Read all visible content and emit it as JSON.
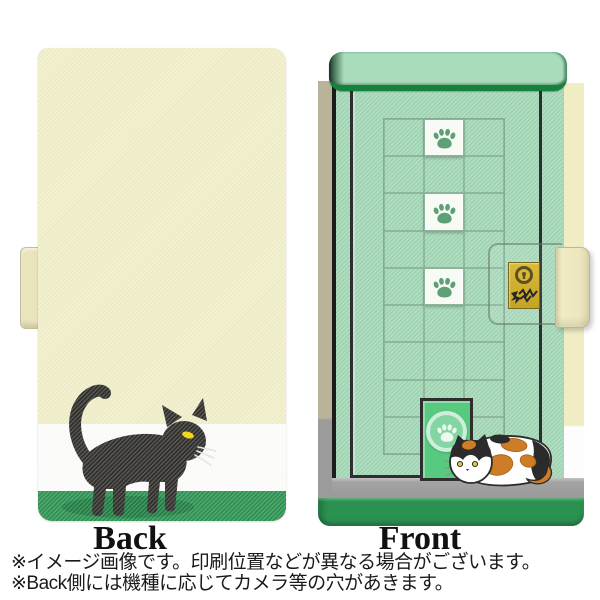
{
  "labels": {
    "back": "Back",
    "front": "Front"
  },
  "footnotes": [
    "※イメージ画像です。印刷位置などが異なる場合がございます。",
    "※Back側には機種に応じてカメラ等の穴があきます。"
  ],
  "back_cover": {
    "bands": {
      "cream": "#f1efc8",
      "white": "#fdfdfb",
      "green": "#2a9150"
    },
    "shadow_color": "#1d7c40",
    "cat_color": "#2e2d2a",
    "eye_color": "#f5d400"
  },
  "front_cover": {
    "mint": "#a0d6b4",
    "door_outline": "#2e2e2e",
    "grid": {
      "cols": 3,
      "rows": 9,
      "line_color": "#86ac94"
    },
    "paw_tiles": {
      "column": 2,
      "rows": [
        1,
        3,
        5
      ],
      "tile_bg": "#f8faf6",
      "paw_color": "#5e9f75"
    },
    "top_bar_border": "#15813f",
    "lock_plate_gold": "#c9a81f",
    "cat_door_green": "#58ca80",
    "floor_gray": "#9e9e9e",
    "bottom_green": "#2a9150",
    "spine_beige": "#b9b39a",
    "fore_edge_cream": "#f0ecc4",
    "strap_cream": "#ece7bf",
    "calico_colors": {
      "white": "#ffffff",
      "orange": "#cd7d26",
      "black": "#2b2b2b"
    }
  }
}
